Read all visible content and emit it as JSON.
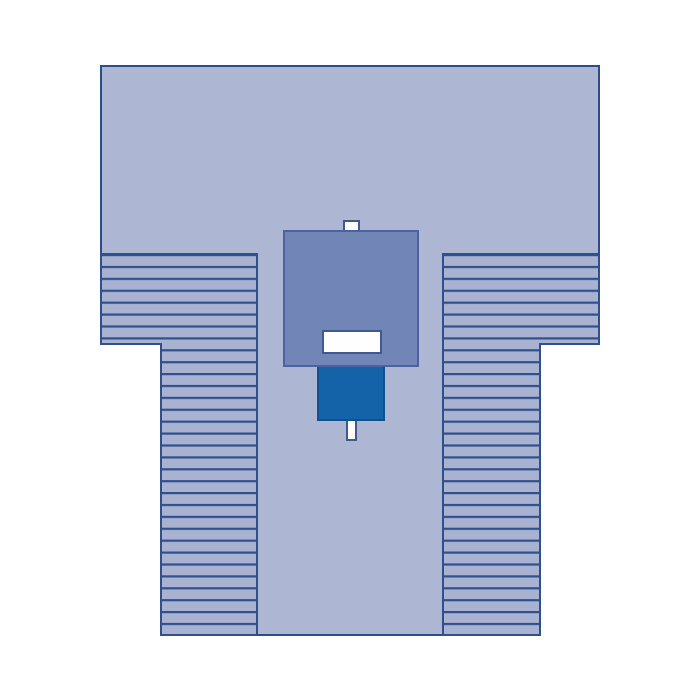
{
  "figure": {
    "kind": "product-illustration",
    "subject_label": ""
  },
  "colors": {
    "page_background": "#ffffff",
    "drape_fill": "#adb6d3",
    "drape_outline": "#2d4d8a",
    "pleat_fill": "#a9b2d1",
    "pleat_line": "#30508c",
    "reinforcement_fill": "#7186b7",
    "reinforcement_outline": "#4a629d",
    "incise_fill": "#1462a7",
    "incise_outline": "#10518c",
    "aperture_fill": "#fefefe",
    "aperture_outline": "#41598f",
    "tab_fill": "#fdfdfd",
    "tab_outline": "#41598f"
  },
  "geometry_notes": {
    "stripe_pitch_px": 11.9,
    "stripe_line_px": 2.2
  }
}
